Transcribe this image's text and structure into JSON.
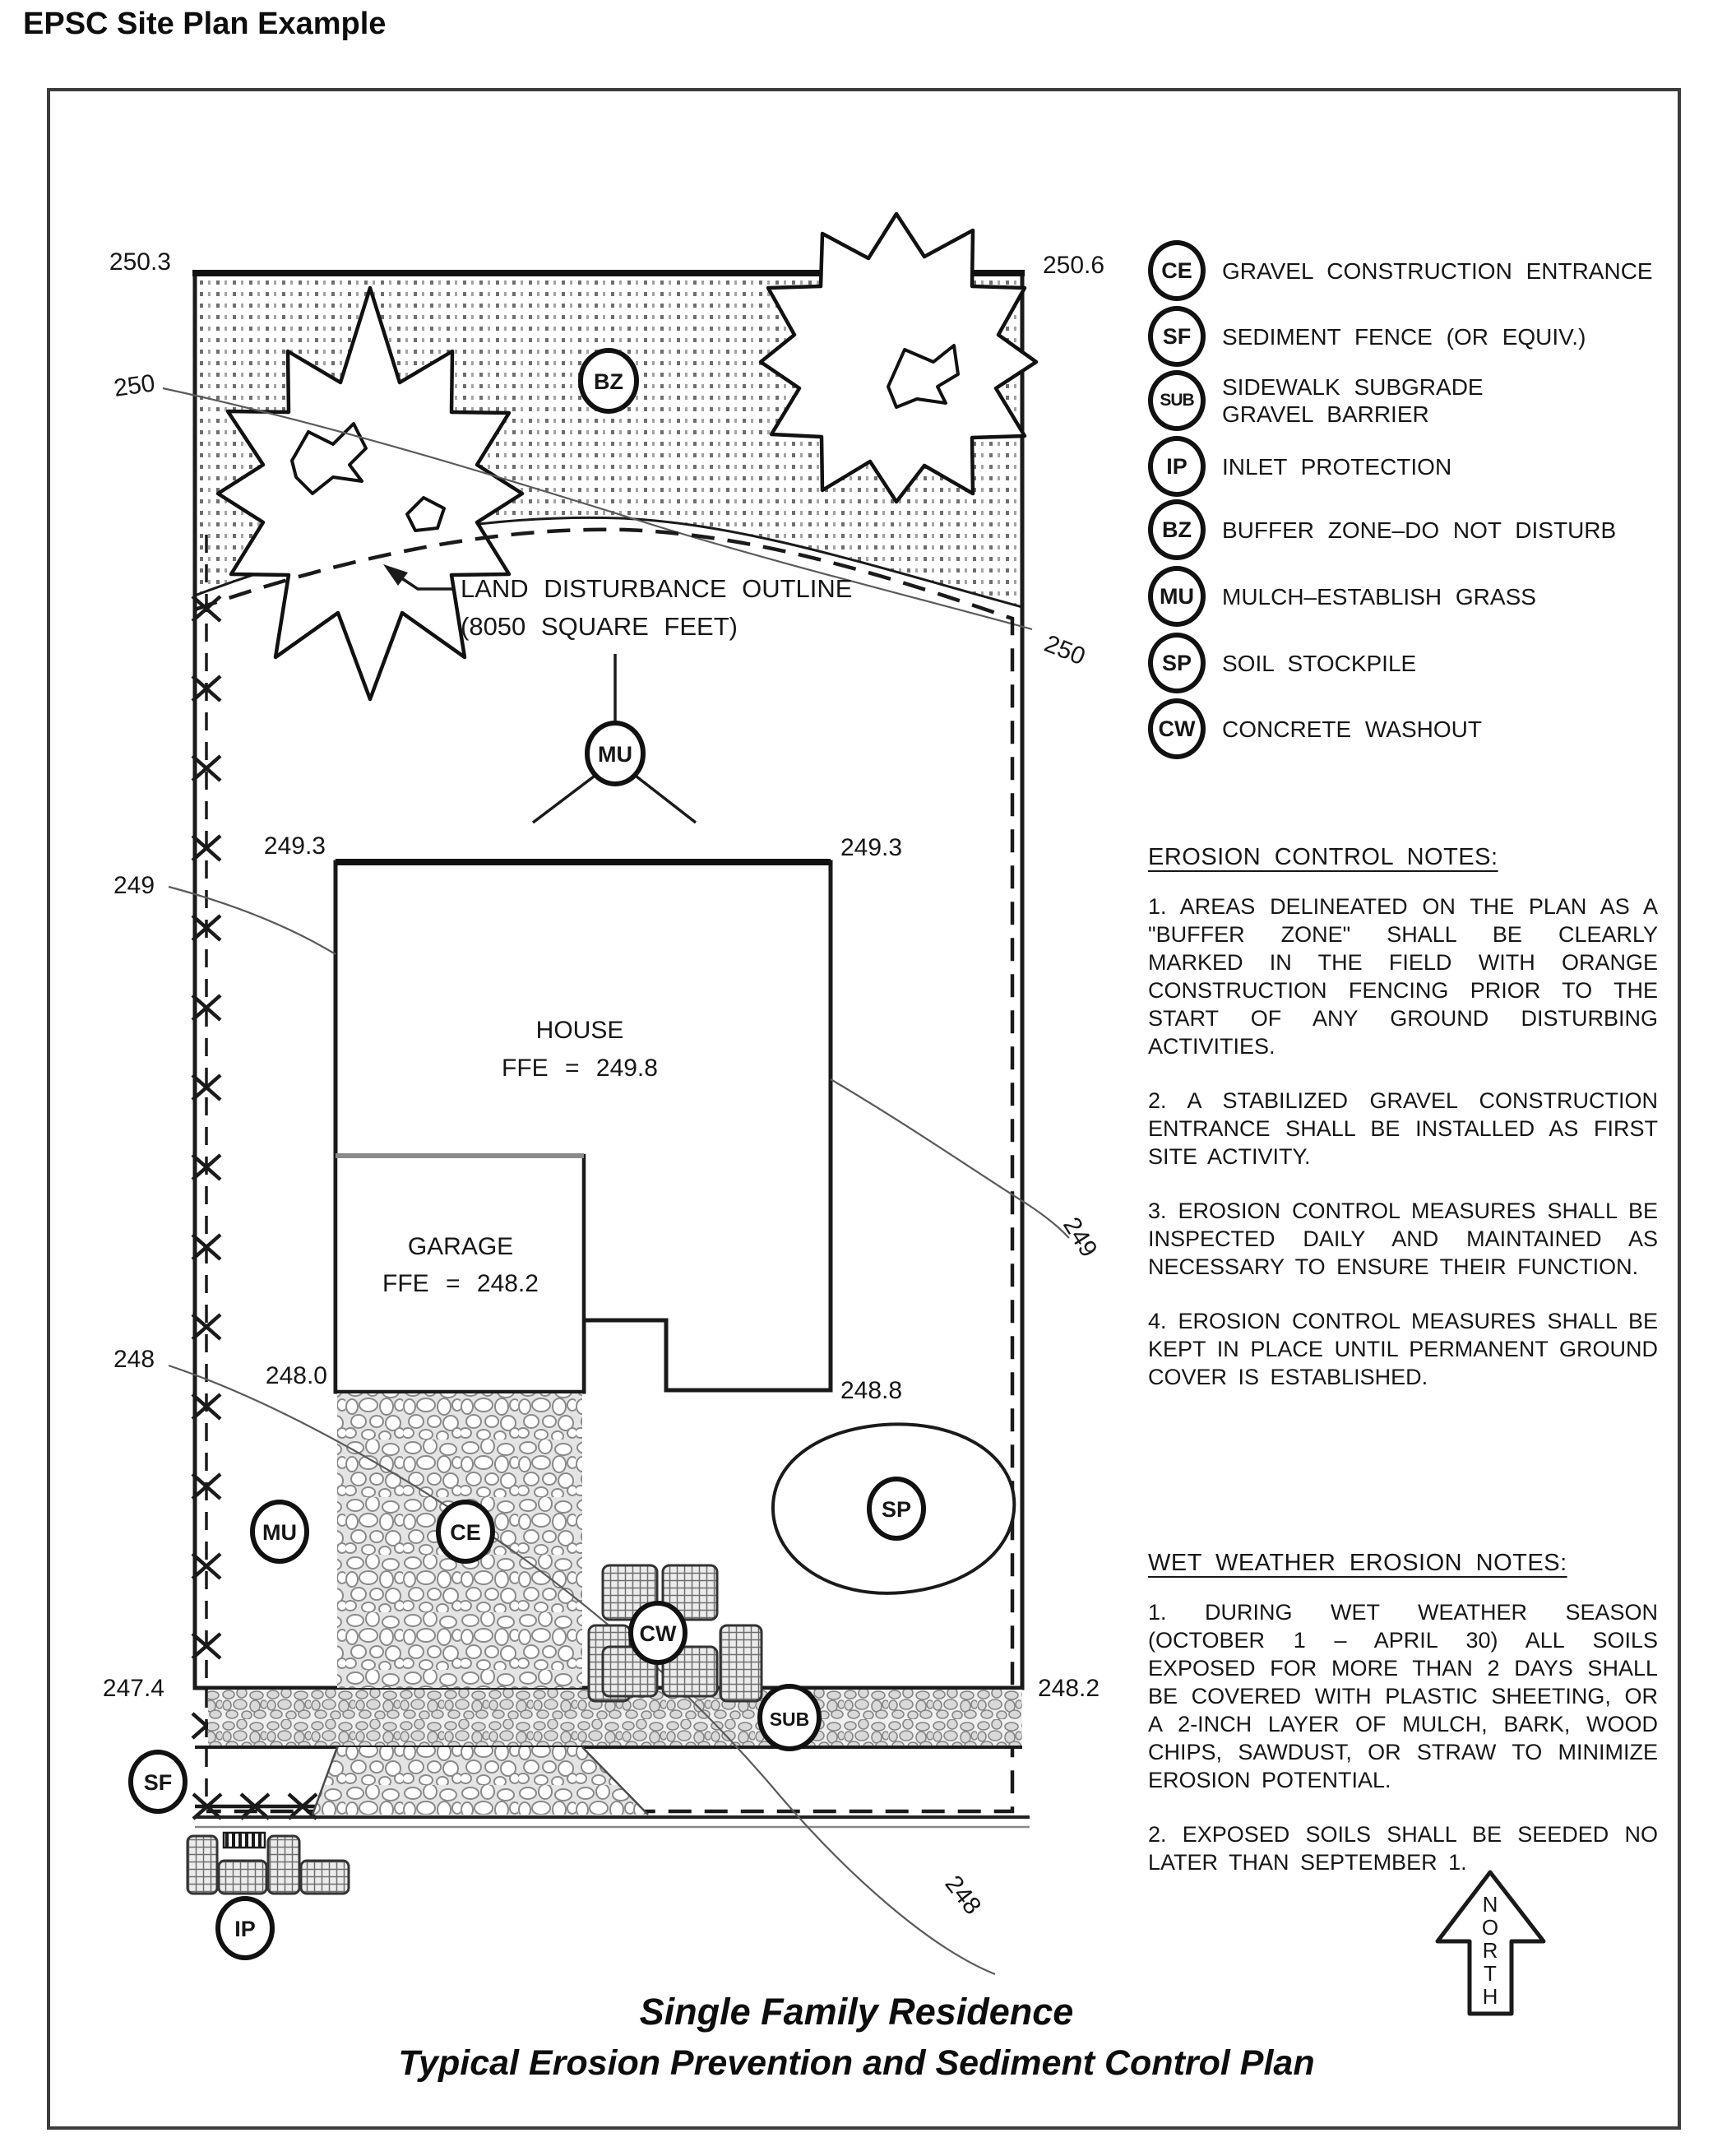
{
  "page": {
    "title": "EPSC Site Plan Example"
  },
  "plan": {
    "corner_labels": {
      "top_left": "250.3",
      "top_right": "250.6",
      "bottom_left": "247.4",
      "bottom_right": "248.2"
    },
    "house": {
      "label": "HOUSE",
      "ffe": "FFE = 249.8",
      "elev_left": "249.3",
      "elev_right": "249.3"
    },
    "garage": {
      "label": "GARAGE",
      "ffe": "FFE = 248.2",
      "elev_left": "248.0",
      "elev_right": "248.8"
    },
    "ldo": {
      "line1": "LAND DISTURBANCE OUTLINE",
      "line2": "(8050 SQUARE FEET)"
    },
    "contours": {
      "c250_left": "250",
      "c250_right": "250",
      "c249_left": "249",
      "c249_right": "249",
      "c248_left": "248",
      "c248_right": "248"
    },
    "symbols": {
      "bz": "BZ",
      "mu_upper": "MU",
      "mu_lower": "MU",
      "ce": "CE",
      "sp": "SP",
      "cw": "CW",
      "sub": "SUB",
      "sf": "SF",
      "ip": "IP"
    }
  },
  "legend": {
    "items": [
      {
        "code": "CE",
        "label": "GRAVEL CONSTRUCTION ENTRANCE"
      },
      {
        "code": "SF",
        "label": "SEDIMENT FENCE (OR EQUIV.)"
      },
      {
        "code": "SUB",
        "label": "SIDEWALK SUBGRADE\nGRAVEL BARRIER"
      },
      {
        "code": "IP",
        "label": "INLET PROTECTION"
      },
      {
        "code": "BZ",
        "label": "BUFFER ZONE–DO NOT DISTURB"
      },
      {
        "code": "MU",
        "label": "MULCH–ESTABLISH GRASS"
      },
      {
        "code": "SP",
        "label": "SOIL STOCKPILE"
      },
      {
        "code": "CW",
        "label": "CONCRETE WASHOUT"
      }
    ]
  },
  "erosion_notes": {
    "heading": "EROSION CONTROL NOTES:",
    "items": [
      "1.  AREAS DELINEATED ON THE PLAN AS A \"BUFFER ZONE\" SHALL BE CLEARLY MARKED IN THE FIELD WITH ORANGE CONSTRUCTION FENCING PRIOR TO THE START OF ANY GROUND DISTURBING ACTIVITIES.",
      "2.  A STABILIZED GRAVEL CONSTRUCTION ENTRANCE SHALL BE INSTALLED AS FIRST SITE ACTIVITY.",
      "3.  EROSION CONTROL MEASURES SHALL BE INSPECTED DAILY AND MAINTAINED AS NECESSARY TO ENSURE THEIR FUNCTION.",
      "4.  EROSION CONTROL MEASURES SHALL BE KEPT IN PLACE UNTIL PERMANENT GROUND COVER IS ESTABLISHED."
    ]
  },
  "wet_weather_notes": {
    "heading": "WET WEATHER EROSION NOTES:",
    "items": [
      "1.  DURING WET WEATHER SEASON (OCTOBER 1 – APRIL 30) ALL SOILS EXPOSED FOR MORE THAN 2 DAYS SHALL BE COVERED WITH PLASTIC SHEETING, OR A 2-INCH LAYER OF MULCH, BARK, WOOD CHIPS, SAWDUST, OR STRAW TO MINIMIZE EROSION POTENTIAL.",
      "2.  EXPOSED SOILS SHALL BE SEEDED NO LATER THAN SEPTEMBER 1."
    ]
  },
  "north": {
    "l1": "N",
    "l2": "O",
    "l3": "R",
    "l4": "T",
    "l5": "H"
  },
  "footer": {
    "line1": "Single Family Residence",
    "line2": "Typical Erosion Prevention and Sediment Control Plan"
  },
  "colors": {
    "ink": "#1a1a1a",
    "gray_line": "#707070",
    "garage_top": "#8a8a8a"
  }
}
